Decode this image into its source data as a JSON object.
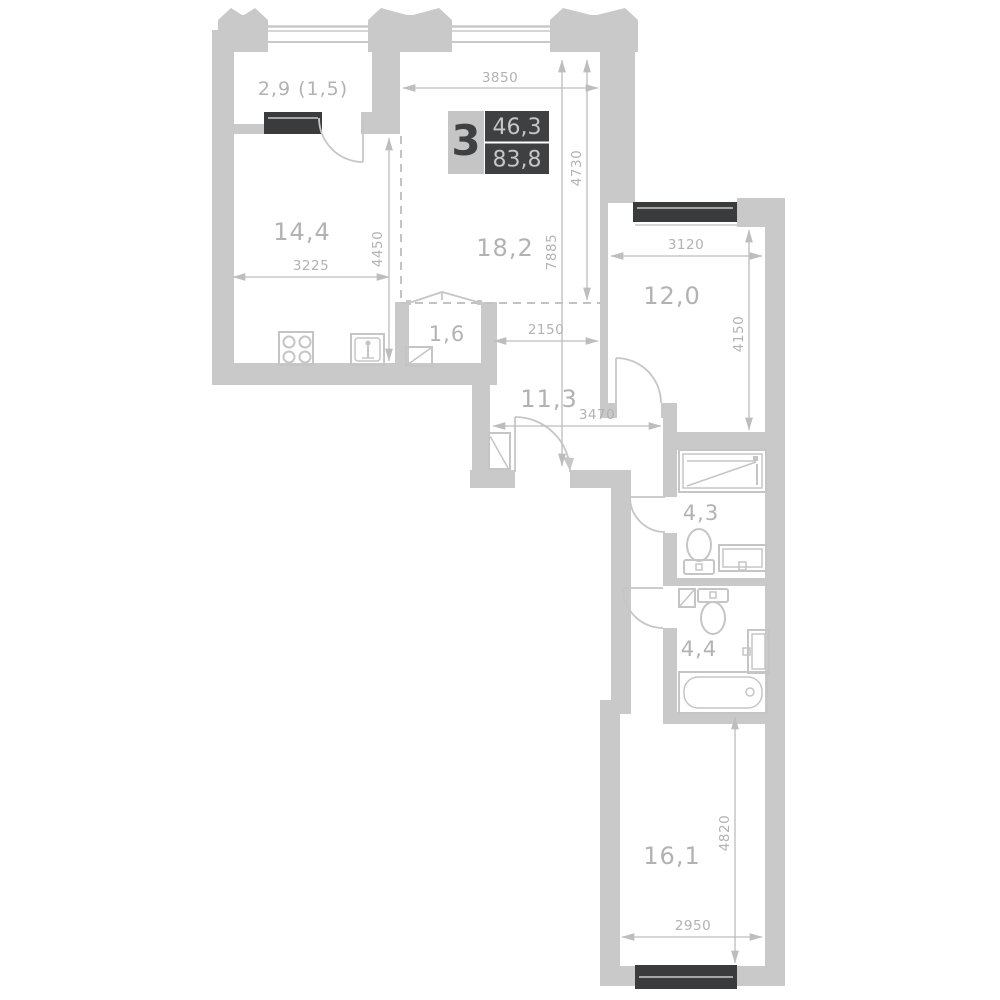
{
  "plan_title": "3-room apartment floor plan",
  "badge": {
    "rooms": "3",
    "area_top": "46,3",
    "area_bottom": "83,8"
  },
  "rooms": {
    "balcony": {
      "label": "2,9 (1,5)"
    },
    "kitchen": {
      "label": "14,4"
    },
    "living": {
      "label": "18,2"
    },
    "wardrobe": {
      "label": "1,6"
    },
    "hallway": {
      "label": "11,3"
    },
    "bedroom1": {
      "label": "12,0"
    },
    "bathroom1": {
      "label": "4,3"
    },
    "bathroom2": {
      "label": "4,4"
    },
    "bedroom2": {
      "label": "16,1"
    }
  },
  "dims": {
    "w3850": {
      "value": "3850"
    },
    "h4730": {
      "value": "4730"
    },
    "h7885": {
      "value": "7885"
    },
    "w3225": {
      "value": "3225"
    },
    "h4450": {
      "value": "4450"
    },
    "w2150": {
      "value": "2150"
    },
    "w3120": {
      "value": "3120"
    },
    "h4150": {
      "value": "4150"
    },
    "w3470": {
      "value": "3470"
    },
    "h4820": {
      "value": "4820"
    },
    "w2950": {
      "value": "2950"
    }
  },
  "colors": {
    "wall": "#c9c9c9",
    "window_block": "#3a3b3d",
    "dimension_line": "#bdbdbd",
    "label_text": "#b2b2b2",
    "badge_dark": "#3e4042",
    "badge_light": "#c5c5c5",
    "background": "#ffffff"
  }
}
